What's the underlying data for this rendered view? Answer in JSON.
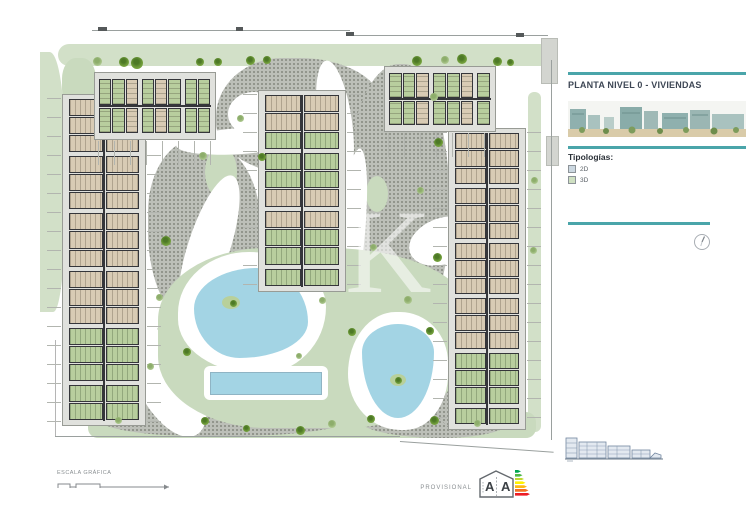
{
  "colors": {
    "accent": "#4aa5aa",
    "gravel": "#bcbfb8",
    "gravelDot": "#8e9289",
    "lawn": "#c9dabe",
    "road": "#d2e0c8",
    "pool": "#a3d4e4",
    "deck": "#e0e1dd",
    "wall": "#35363a",
    "unitTan": "#d8cbb4",
    "unitGreen": "#b8ce9e",
    "treeSageLight": "#b8d09b",
    "lineGray": "#b2b5af"
  },
  "panel": {
    "title": "PLANTA NIVEL 0 - VIVIENDAS",
    "typologies_label": "Tipologías:",
    "legend": [
      {
        "id": "2d",
        "label": "2D",
        "color": "#ccd8e1"
      },
      {
        "id": "3d",
        "label": "3D",
        "color": "#cfe0c2"
      }
    ]
  },
  "footer": {
    "scale_label": "ESCALA GRÁFICA",
    "provisional_label": "PROVISIONAL",
    "energy_letters": [
      "A",
      "A"
    ],
    "energy_colors": [
      "#00a651",
      "#50b848",
      "#bfd730",
      "#fff200",
      "#fdb913",
      "#f37021",
      "#ed1c24"
    ]
  },
  "plan": {
    "watermark": "K",
    "buildings": [
      {
        "id": "block-west",
        "x": 62,
        "y": 94,
        "w": 84,
        "h": 332,
        "orient": "v",
        "units": 17,
        "typ": "ttttttttttttggggg"
      },
      {
        "id": "block-center",
        "x": 258,
        "y": 90,
        "w": 88,
        "h": 202,
        "orient": "v",
        "units": 10,
        "typ": "ttgggttggg"
      },
      {
        "id": "block-east",
        "x": 448,
        "y": 128,
        "w": 78,
        "h": 302,
        "orient": "v",
        "units": 16,
        "typ": "ttttttttttttgggg"
      },
      {
        "id": "block-north-west",
        "x": 94,
        "y": 72,
        "w": 122,
        "h": 68,
        "orient": "h",
        "units": 8,
        "typ": "ggtgtggg"
      },
      {
        "id": "block-north-east",
        "x": 384,
        "y": 66,
        "w": 112,
        "h": 66,
        "orient": "h",
        "units": 7,
        "typ": "ggtggtg"
      }
    ],
    "trees": [
      {
        "x": 97,
        "y": 61,
        "d": 9,
        "v": "s"
      },
      {
        "x": 124,
        "y": 62,
        "d": 10,
        "v": "o"
      },
      {
        "x": 137,
        "y": 63,
        "d": 12,
        "v": "o"
      },
      {
        "x": 200,
        "y": 62,
        "d": 8,
        "v": "o"
      },
      {
        "x": 218,
        "y": 62,
        "d": 8,
        "v": "o"
      },
      {
        "x": 250,
        "y": 60,
        "d": 9,
        "v": "o"
      },
      {
        "x": 267,
        "y": 60,
        "d": 8,
        "v": "o"
      },
      {
        "x": 417,
        "y": 61,
        "d": 10,
        "v": "o"
      },
      {
        "x": 445,
        "y": 60,
        "d": 8,
        "v": "s"
      },
      {
        "x": 462,
        "y": 59,
        "d": 10,
        "v": "o"
      },
      {
        "x": 497,
        "y": 61,
        "d": 9,
        "v": "o"
      },
      {
        "x": 510,
        "y": 62,
        "d": 7,
        "v": "o"
      },
      {
        "x": 166,
        "y": 241,
        "d": 10,
        "v": "o"
      },
      {
        "x": 159,
        "y": 297,
        "d": 7,
        "v": "s"
      },
      {
        "x": 203,
        "y": 156,
        "d": 8,
        "v": "s"
      },
      {
        "x": 262,
        "y": 157,
        "d": 8,
        "v": "o"
      },
      {
        "x": 240,
        "y": 118,
        "d": 7,
        "v": "s"
      },
      {
        "x": 438,
        "y": 142,
        "d": 9,
        "v": "o"
      },
      {
        "x": 434,
        "y": 97,
        "d": 8,
        "v": "s"
      },
      {
        "x": 420,
        "y": 190,
        "d": 7,
        "v": "s"
      },
      {
        "x": 437,
        "y": 257,
        "d": 9,
        "v": "o"
      },
      {
        "x": 373,
        "y": 247,
        "d": 7,
        "v": "s"
      },
      {
        "x": 408,
        "y": 300,
        "d": 8,
        "v": "s"
      },
      {
        "x": 187,
        "y": 352,
        "d": 8,
        "v": "o"
      },
      {
        "x": 150,
        "y": 366,
        "d": 7,
        "v": "s"
      },
      {
        "x": 322,
        "y": 300,
        "d": 7,
        "v": "s"
      },
      {
        "x": 352,
        "y": 332,
        "d": 8,
        "v": "o"
      },
      {
        "x": 430,
        "y": 331,
        "d": 8,
        "v": "o"
      },
      {
        "x": 299,
        "y": 356,
        "d": 6,
        "v": "s"
      },
      {
        "x": 118,
        "y": 420,
        "d": 7,
        "v": "s"
      },
      {
        "x": 205,
        "y": 421,
        "d": 8,
        "v": "o"
      },
      {
        "x": 246,
        "y": 428,
        "d": 7,
        "v": "o"
      },
      {
        "x": 300,
        "y": 430,
        "d": 9,
        "v": "o"
      },
      {
        "x": 332,
        "y": 424,
        "d": 8,
        "v": "s"
      },
      {
        "x": 371,
        "y": 419,
        "d": 8,
        "v": "o"
      },
      {
        "x": 434,
        "y": 420,
        "d": 9,
        "v": "o"
      },
      {
        "x": 477,
        "y": 423,
        "d": 7,
        "v": "s"
      },
      {
        "x": 533,
        "y": 250,
        "d": 7,
        "v": "s"
      },
      {
        "x": 534,
        "y": 180,
        "d": 7,
        "v": "s"
      },
      {
        "x": 233,
        "y": 303,
        "d": 7,
        "v": "o"
      },
      {
        "x": 398,
        "y": 380,
        "d": 7,
        "v": "o"
      }
    ]
  }
}
